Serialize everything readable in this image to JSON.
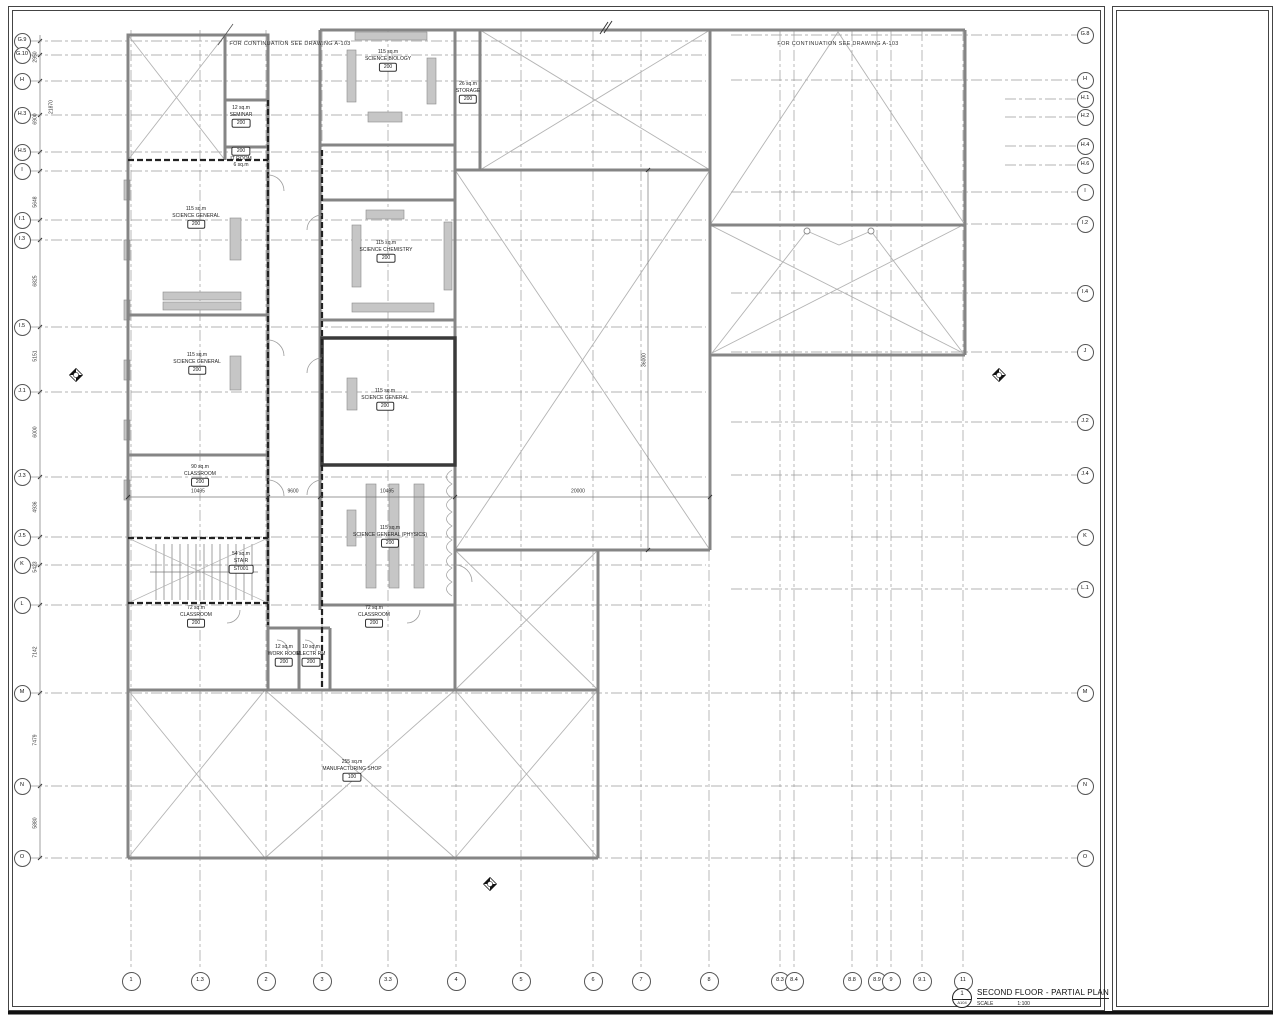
{
  "colors": {
    "wall": "#858585",
    "dark_wall": "#3a3a3a",
    "grid_line": "#9b9b9b",
    "bench_fill": "#c6c6c6",
    "text": "#222222"
  },
  "notes": {
    "continuation": "FOR CONTINUATION SEE DRAWING A-103"
  },
  "grid": {
    "left": [
      {
        "label": "G.9",
        "y": 41
      },
      {
        "label": "G.10",
        "y": 55
      },
      {
        "label": "H",
        "y": 81
      },
      {
        "label": "H.3",
        "y": 115
      },
      {
        "label": "H.5",
        "y": 152
      },
      {
        "label": "I",
        "y": 171
      },
      {
        "label": "I.1",
        "y": 220
      },
      {
        "label": "I.3",
        "y": 240
      },
      {
        "label": "I.5",
        "y": 327
      },
      {
        "label": "J.1",
        "y": 392
      },
      {
        "label": "J.3",
        "y": 477
      },
      {
        "label": "J.5",
        "y": 537
      },
      {
        "label": "K",
        "y": 565
      },
      {
        "label": "L",
        "y": 605
      },
      {
        "label": "M",
        "y": 693
      },
      {
        "label": "N",
        "y": 786
      },
      {
        "label": "O",
        "y": 858
      }
    ],
    "right": [
      {
        "label": "G.8",
        "y": 35
      },
      {
        "label": "H",
        "y": 80
      },
      {
        "label": "H.1",
        "y": 99
      },
      {
        "label": "H.2",
        "y": 117
      },
      {
        "label": "H.4",
        "y": 146
      },
      {
        "label": "H.6",
        "y": 165
      },
      {
        "label": "I",
        "y": 192
      },
      {
        "label": "I.2",
        "y": 224
      },
      {
        "label": "I.4",
        "y": 293
      },
      {
        "label": "J",
        "y": 352
      },
      {
        "label": "J.2",
        "y": 422
      },
      {
        "label": "J.4",
        "y": 475
      },
      {
        "label": "K",
        "y": 537
      },
      {
        "label": "L.1",
        "y": 589
      },
      {
        "label": "M",
        "y": 693
      },
      {
        "label": "N",
        "y": 786
      },
      {
        "label": "O",
        "y": 858
      }
    ],
    "bottom": [
      {
        "label": "1",
        "x": 131
      },
      {
        "label": "1.3",
        "x": 200
      },
      {
        "label": "2",
        "x": 266
      },
      {
        "label": "3",
        "x": 322
      },
      {
        "label": "3.3",
        "x": 388
      },
      {
        "label": "4",
        "x": 456
      },
      {
        "label": "5",
        "x": 521
      },
      {
        "label": "6",
        "x": 593
      },
      {
        "label": "7",
        "x": 641
      },
      {
        "label": "8",
        "x": 709
      },
      {
        "label": "8.3",
        "x": 780
      },
      {
        "label": "8.4",
        "x": 794
      },
      {
        "label": "8.8",
        "x": 852
      },
      {
        "label": "8.9",
        "x": 877
      },
      {
        "label": "9",
        "x": 891
      },
      {
        "label": "9.1",
        "x": 922
      },
      {
        "label": "11",
        "x": 963
      }
    ]
  },
  "rooms": [
    {
      "area": "115 sq.m",
      "name": "SCIENCE BIOLOGY",
      "tag": "200",
      "x": 388,
      "y": 60,
      "tag_above": false
    },
    {
      "area": "26 sq.m",
      "name": "STORAGE",
      "tag": "200",
      "x": 468,
      "y": 92,
      "tag_above": false
    },
    {
      "area": "12 sq.m",
      "name": "SEMINAR",
      "tag": "200",
      "x": 241,
      "y": 116,
      "tag_above": false
    },
    {
      "area": "6 sq.m",
      "name": "IT ROOM",
      "tag": "200",
      "x": 241,
      "y": 157,
      "tag_above": true
    },
    {
      "area": "115 sq.m",
      "name": "SCIENCE GENERAL",
      "tag": "200",
      "x": 196,
      "y": 217,
      "tag_above": false
    },
    {
      "area": "115 sq.m",
      "name": "SCIENCE CHEMISTRY",
      "tag": "200",
      "x": 386,
      "y": 251,
      "tag_above": false
    },
    {
      "area": "115 sq.m",
      "name": "SCIENCE GENERAL",
      "tag": "200",
      "x": 197,
      "y": 363,
      "tag_above": false
    },
    {
      "area": "115 sq.m",
      "name": "SCIENCE GENERAL",
      "tag": "200",
      "x": 385,
      "y": 399,
      "tag_above": false
    },
    {
      "area": "90 sq.m",
      "name": "CLASSROOM",
      "tag": "200",
      "x": 200,
      "y": 475,
      "tag_above": false
    },
    {
      "area": "115 sq.m",
      "name": "SCIENCE GENERAL (PHYSICS)",
      "tag": "200",
      "x": 390,
      "y": 536,
      "tag_above": false
    },
    {
      "area": "54 sq.m",
      "name": "STAIR",
      "tag": "ST001",
      "x": 241,
      "y": 562,
      "tag_above": false
    },
    {
      "area": "72 sq.m",
      "name": "CLASSROOM",
      "tag": "200",
      "x": 196,
      "y": 616,
      "tag_above": false
    },
    {
      "area": "72 sq.m",
      "name": "CLASSROOM",
      "tag": "200",
      "x": 374,
      "y": 616,
      "tag_above": false
    },
    {
      "area": "12 sq.m",
      "name": "WORK ROOM",
      "tag": "200",
      "x": 284,
      "y": 655,
      "tag_above": false
    },
    {
      "area": "10 sq.m",
      "name": "ELECTR RM",
      "tag": "200",
      "x": 311,
      "y": 655,
      "tag_above": false
    },
    {
      "area": "255 sq.m",
      "name": "MANUFACTURING SHOP",
      "tag": "100",
      "x": 352,
      "y": 770,
      "tag_above": false
    }
  ],
  "dimensions": {
    "horizontal": [
      {
        "text": "10495",
        "x": 198,
        "y": 492
      },
      {
        "text": "9600",
        "x": 293,
        "y": 492
      },
      {
        "text": "10495",
        "x": 387,
        "y": 492
      },
      {
        "text": "20000",
        "x": 578,
        "y": 492
      }
    ],
    "vertical": [
      {
        "text": "2950",
        "x": 36,
        "y": 57
      },
      {
        "text": "6900",
        "x": 36,
        "y": 119
      },
      {
        "text": "21870",
        "x": 52,
        "y": 107
      },
      {
        "text": "5648",
        "x": 36,
        "y": 202
      },
      {
        "text": "6825",
        "x": 36,
        "y": 281
      },
      {
        "text": "5151",
        "x": 36,
        "y": 356
      },
      {
        "text": "6000",
        "x": 36,
        "y": 432
      },
      {
        "text": "4936",
        "x": 36,
        "y": 507
      },
      {
        "text": "5423",
        "x": 36,
        "y": 567
      },
      {
        "text": "7142",
        "x": 36,
        "y": 652
      },
      {
        "text": "7479",
        "x": 36,
        "y": 740
      },
      {
        "text": "5880",
        "x": 36,
        "y": 823
      },
      {
        "text": "36000",
        "x": 645,
        "y": 360
      }
    ]
  },
  "title_block": {
    "detail_number": "1",
    "sheet_ref": "A104",
    "title": "SECOND FLOOR - PARTIAL PLAN",
    "scale_label": "SCALE",
    "scale_value": "1:100"
  }
}
